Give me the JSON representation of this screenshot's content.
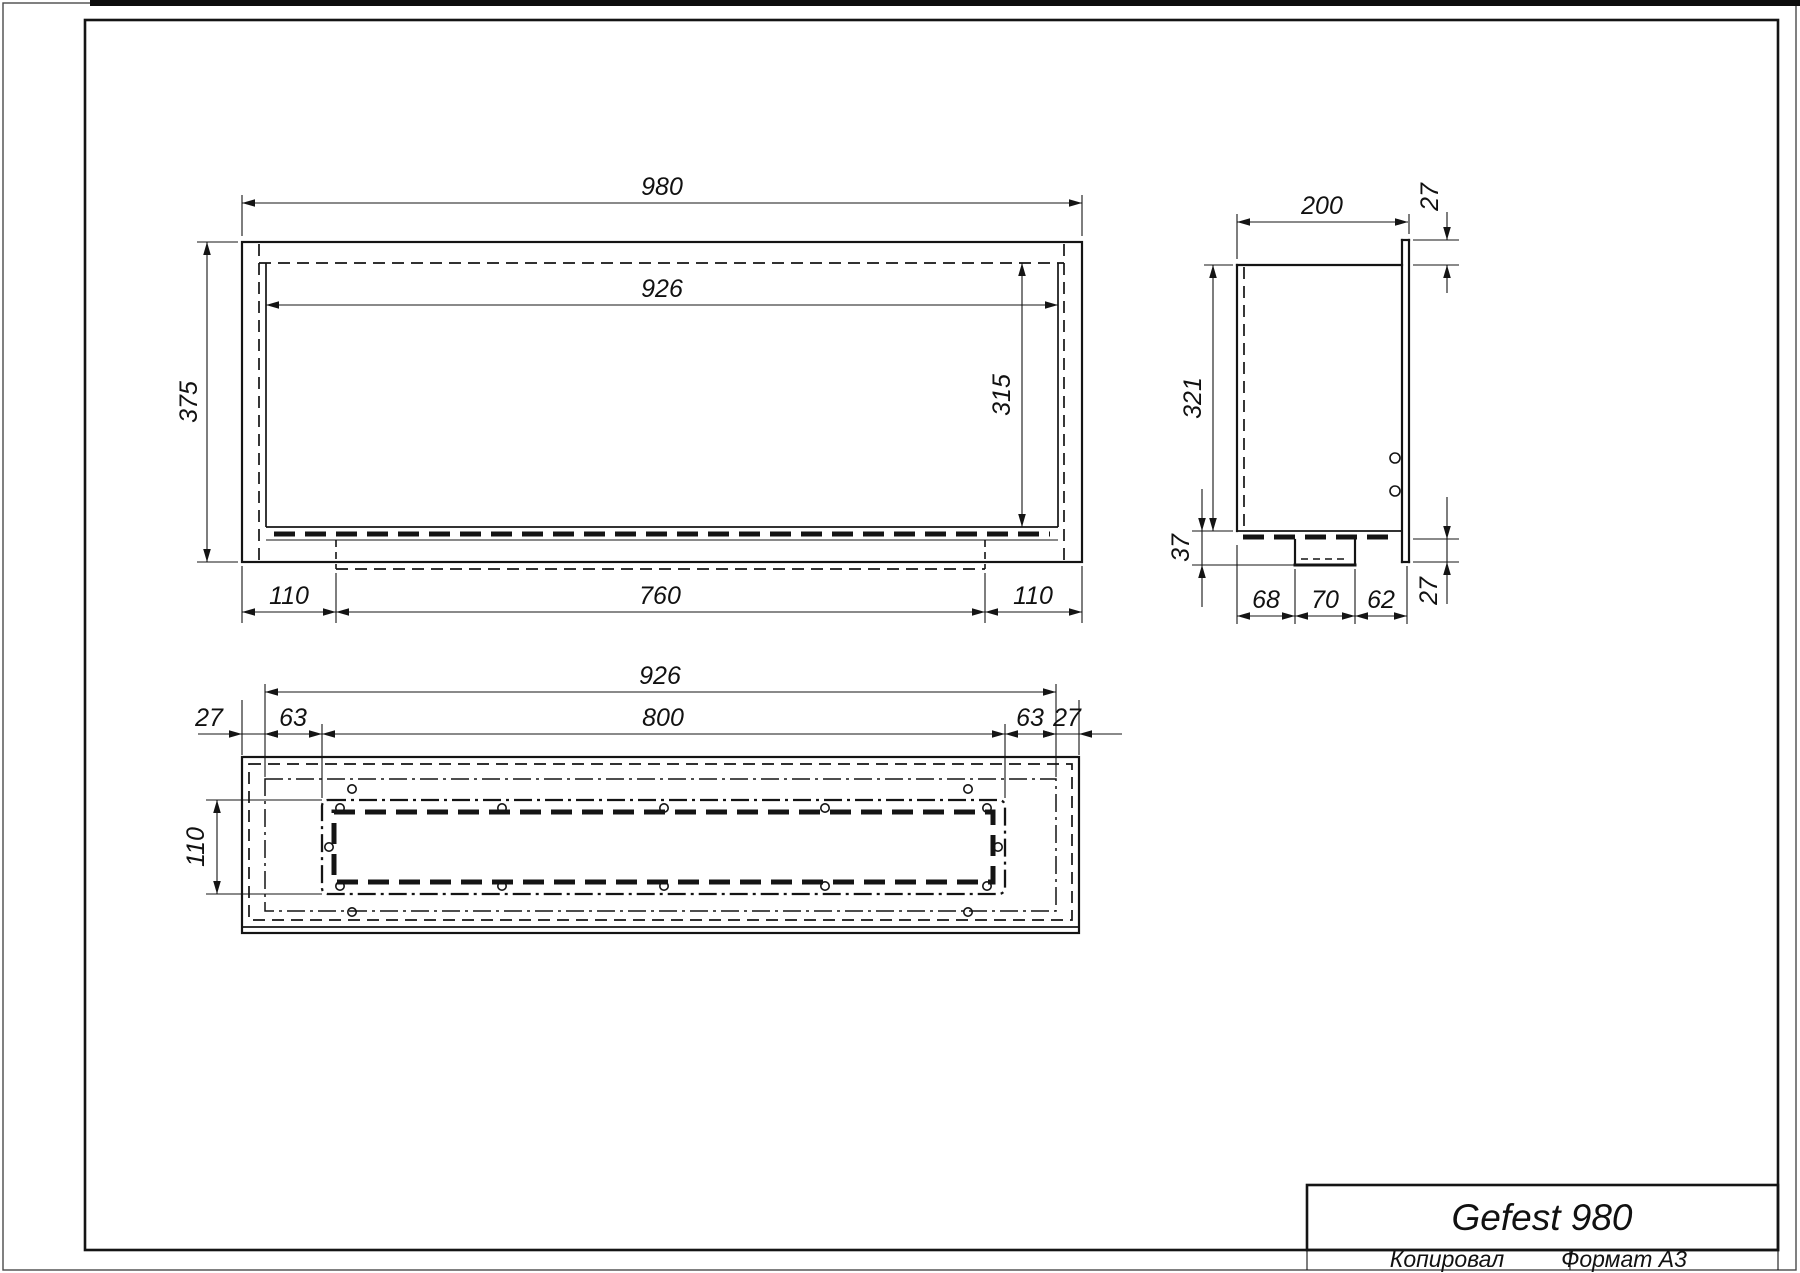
{
  "title_block": {
    "name": "Gefest 980"
  },
  "page": {
    "copied_label": "Копировал",
    "format_label": "Формат А3"
  },
  "front_view": {
    "width": "980",
    "opening_width": "926",
    "height": "375",
    "opening_height": "315",
    "left_offset": "110",
    "tray_width": "760",
    "right_offset": "110"
  },
  "side_view": {
    "depth": "200",
    "flange_top": "27",
    "inner_height": "321",
    "tray_depth": "37",
    "seg_a": "68",
    "seg_b": "70",
    "seg_c": "62",
    "flange_bottom": "27"
  },
  "bottom_view": {
    "frame_width": "926",
    "slot_width": "800",
    "edge_left": "27",
    "offset_left": "63",
    "offset_right": "63",
    "edge_right": "27",
    "slot_height": "110"
  }
}
